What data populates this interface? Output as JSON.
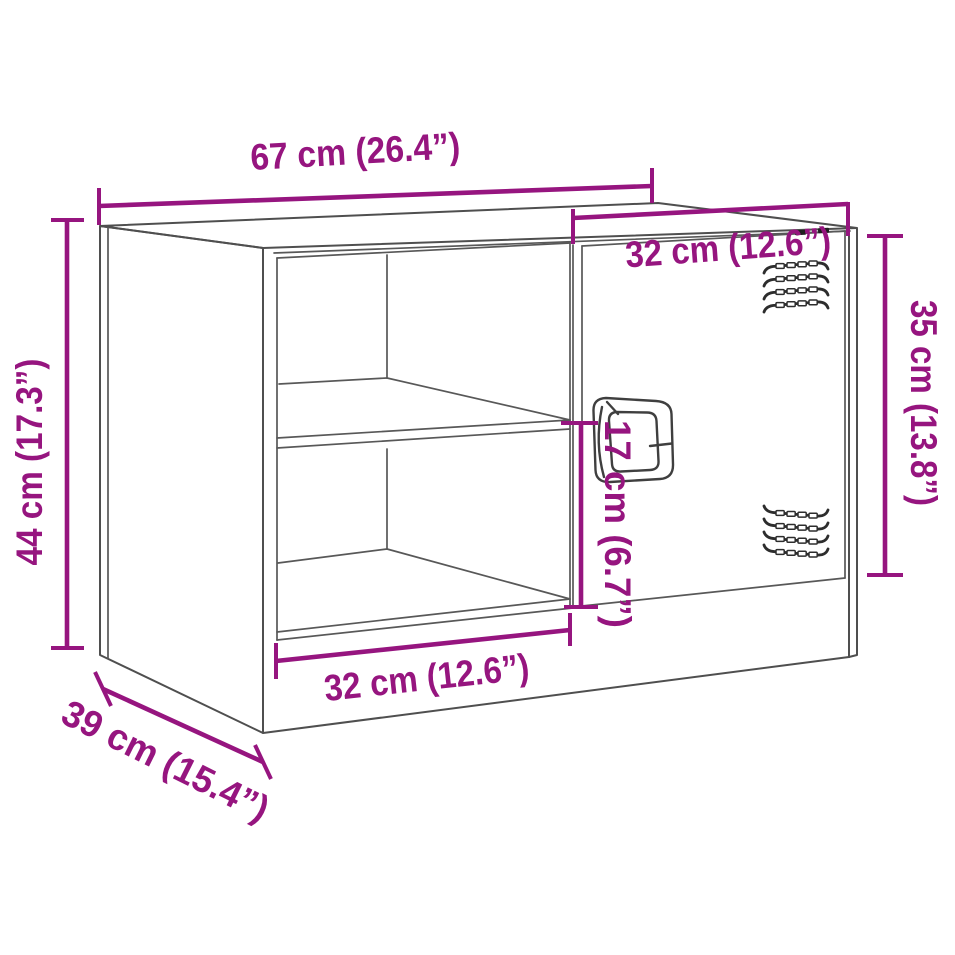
{
  "drawing": {
    "subject": "TV cabinet with two open shelf compartments and one ventilated door",
    "view": "three-quarter perspective dimension diagram",
    "background_color": "#ffffff",
    "accent_color": "#96157f",
    "outline_color": "#4f4f4f"
  },
  "dims": {
    "total_width": {
      "label": "67 cm (26.4”)",
      "value_cm": 67,
      "value_in": 26.4
    },
    "door_width": {
      "label": "32 cm (12.6”)",
      "value_cm": 32,
      "value_in": 12.6
    },
    "door_height": {
      "label": "35 cm (13.8”)",
      "value_cm": 35,
      "value_in": 13.8
    },
    "total_height": {
      "label": "44 cm (17.3”)",
      "value_cm": 44,
      "value_in": 17.3
    },
    "handle_height": {
      "label": "17 cm (6.7”)",
      "value_cm": 17,
      "value_in": 6.7
    },
    "opening_width": {
      "label": "32 cm (12.6”)",
      "value_cm": 32,
      "value_in": 12.6
    },
    "depth": {
      "label": "39 cm (15.4”)",
      "value_cm": 39,
      "value_in": 15.4
    }
  }
}
